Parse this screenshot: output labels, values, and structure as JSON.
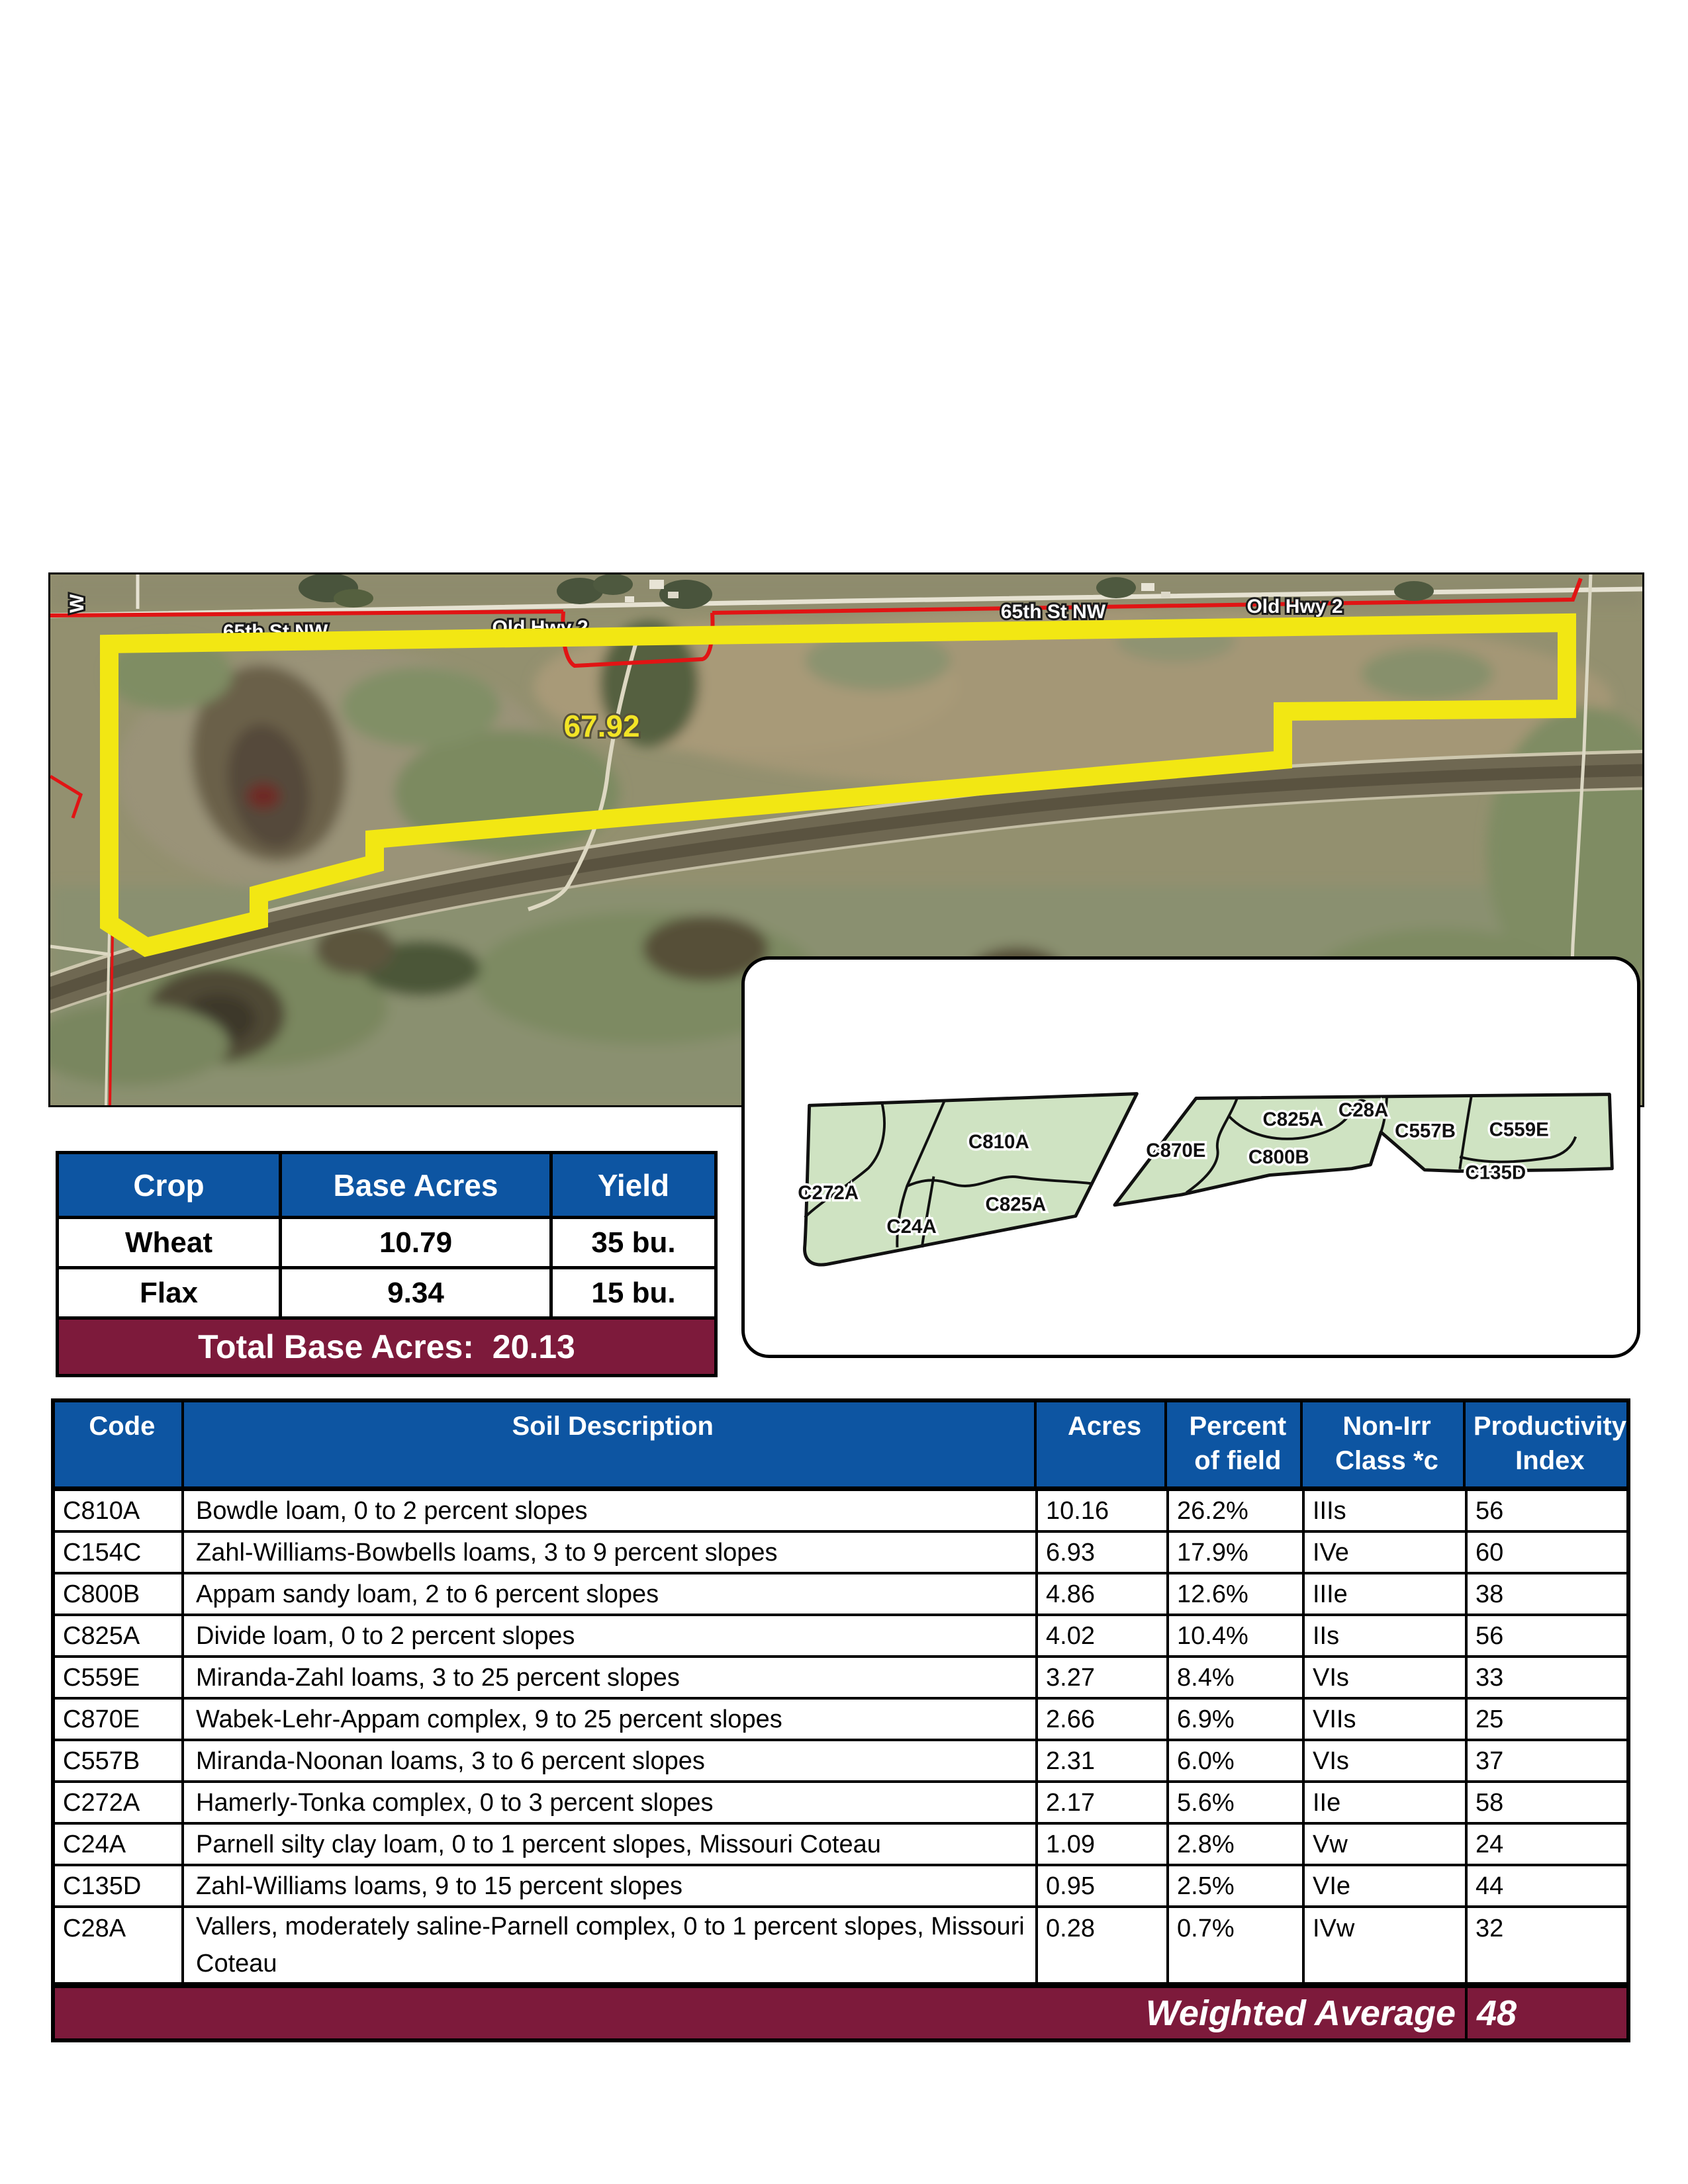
{
  "colors": {
    "header_blue": "#0d55a2",
    "footer_maroon": "#7d1a3b",
    "map_green": "#cfe3c2",
    "boundary_yellow": "#f2e713"
  },
  "aerial": {
    "field_label": "67.92",
    "road_labels": [
      "65th St NW",
      "Old Hwy 2",
      "65th St NW",
      "Old Hwy 2"
    ],
    "edge_label": "W"
  },
  "crop_table": {
    "headers": [
      "Crop",
      "Base Acres",
      "Yield"
    ],
    "rows": [
      [
        "Wheat",
        "10.79",
        "35 bu."
      ],
      [
        "Flax",
        "9.34",
        "15 bu."
      ]
    ],
    "footer": "Total Base Acres:  20.13"
  },
  "soil_map": {
    "labels": [
      "C272A",
      "C810A",
      "C24A",
      "C825A",
      "C870E",
      "C825A",
      "C28A",
      "C800B",
      "C557B",
      "C559E",
      "C135D"
    ]
  },
  "soil_table": {
    "headers": [
      "Code",
      "Soil Description",
      "Acres",
      "Percent of field",
      "Non-Irr Class *c",
      "Productivity Index"
    ],
    "rows": [
      [
        "C810A",
        "Bowdle loam, 0 to 2 percent slopes",
        "10.16",
        "26.2%",
        "IIIs",
        "56"
      ],
      [
        "C154C",
        "Zahl-Williams-Bowbells loams, 3 to 9 percent slopes",
        "6.93",
        "17.9%",
        "IVe",
        "60"
      ],
      [
        "C800B",
        "Appam sandy loam, 2 to 6 percent slopes",
        "4.86",
        "12.6%",
        "IIIe",
        "38"
      ],
      [
        "C825A",
        "Divide loam, 0 to 2 percent slopes",
        "4.02",
        "10.4%",
        "IIs",
        "56"
      ],
      [
        "C559E",
        "Miranda-Zahl loams, 3 to 25 percent slopes",
        "3.27",
        "8.4%",
        "VIs",
        "33"
      ],
      [
        "C870E",
        "Wabek-Lehr-Appam complex, 9 to 25 percent slopes",
        "2.66",
        "6.9%",
        "VIIs",
        "25"
      ],
      [
        "C557B",
        "Miranda-Noonan loams, 3 to 6 percent slopes",
        "2.31",
        "6.0%",
        "VIs",
        "37"
      ],
      [
        "C272A",
        "Hamerly-Tonka complex, 0 to 3 percent slopes",
        "2.17",
        "5.6%",
        "IIe",
        "58"
      ],
      [
        "C24A",
        "Parnell silty clay loam, 0 to 1 percent slopes, Missouri Coteau",
        "1.09",
        "2.8%",
        "Vw",
        "24"
      ],
      [
        "C135D",
        "Zahl-Williams loams, 9 to 15 percent slopes",
        "0.95",
        "2.5%",
        "VIe",
        "44"
      ],
      [
        "C28A",
        "Vallers, moderately saline-Parnell complex, 0 to 1 percent slopes, Missouri Coteau",
        "0.28",
        "0.7%",
        "IVw",
        "32"
      ]
    ],
    "footer_label": "Weighted Average",
    "footer_value": "48"
  }
}
